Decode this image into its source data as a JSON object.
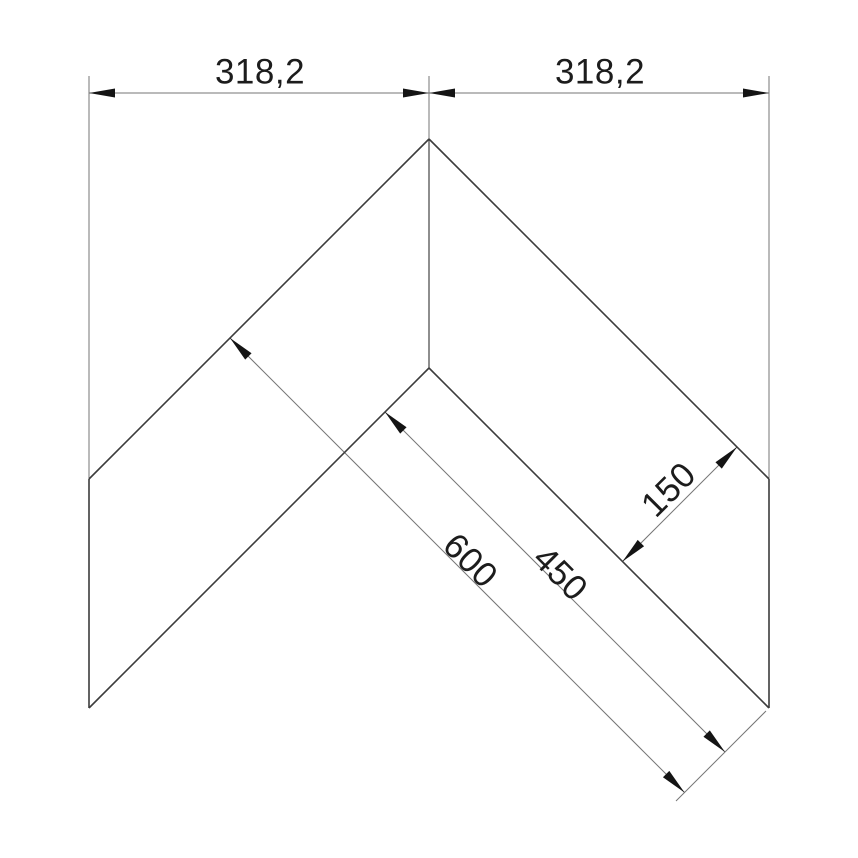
{
  "canvas": {
    "width": 858,
    "height": 858,
    "background": "#ffffff"
  },
  "palette": {
    "edge_color": "#3c3c3c",
    "crease_color": "#444444",
    "dim_line_color": "#757575",
    "arrow_fill": "#141414",
    "label_color": "#1c1c1c"
  },
  "drawing": {
    "type": "technical-dimension-drawing",
    "edges": [
      {
        "name": "outer-left-edge",
        "x1": 429,
        "y1": 139,
        "x2": 89,
        "y2": 479
      },
      {
        "name": "left-end-edge",
        "x1": 89,
        "y1": 479,
        "x2": 89,
        "y2": 708
      },
      {
        "name": "inner-left-edge",
        "x1": 89,
        "y1": 708,
        "x2": 429,
        "y2": 368
      },
      {
        "name": "outer-right-edge",
        "x1": 429,
        "y1": 139,
        "x2": 769,
        "y2": 479
      },
      {
        "name": "right-end-edge",
        "x1": 769,
        "y1": 479,
        "x2": 769,
        "y2": 708
      },
      {
        "name": "inner-right-edge",
        "x1": 429,
        "y1": 368,
        "x2": 769,
        "y2": 708
      }
    ],
    "crease_lines": [
      {
        "name": "corner-crease-line",
        "x1": 429,
        "y1": 139,
        "x2": 429,
        "y2": 368
      }
    ],
    "extension_lines": [
      {
        "name": "extension-line-left",
        "x1": 89,
        "y1": 76,
        "x2": 89,
        "y2": 479
      },
      {
        "name": "extension-line-center",
        "x1": 429,
        "y1": 76,
        "x2": 429,
        "y2": 139
      },
      {
        "name": "extension-line-right",
        "x1": 769,
        "y1": 76,
        "x2": 769,
        "y2": 479
      },
      {
        "name": "extension-line-end-plane",
        "x1": 766,
        "y1": 711,
        "x2": 676,
        "y2": 801
      }
    ],
    "dimension_lines": [
      {
        "name": "dim-line-318-left",
        "x1": 89,
        "y1": 93,
        "x2": 429,
        "y2": 93
      },
      {
        "name": "dim-line-318-right",
        "x1": 429,
        "y1": 93,
        "x2": 769,
        "y2": 93
      },
      {
        "name": "dim-line-600",
        "x1": 230,
        "y1": 338,
        "x2": 684.5,
        "y2": 792.5
      },
      {
        "name": "dim-line-450",
        "x1": 385,
        "y1": 412,
        "x2": 725,
        "y2": 752
      },
      {
        "name": "dim-line-150",
        "x1": 622.5,
        "y1": 561.5,
        "x2": 737,
        "y2": 447
      }
    ],
    "arrowheads": [
      {
        "name": "arrow-318-left-outer",
        "x": 89,
        "y": 93,
        "angle": 180
      },
      {
        "name": "arrow-318-left-inner",
        "x": 429,
        "y": 93,
        "angle": 0
      },
      {
        "name": "arrow-318-right-inner",
        "x": 429,
        "y": 93,
        "angle": 180
      },
      {
        "name": "arrow-318-right-outer",
        "x": 769,
        "y": 93,
        "angle": 0
      },
      {
        "name": "arrow-600-start",
        "x": 230,
        "y": 338,
        "angle": 225
      },
      {
        "name": "arrow-600-end",
        "x": 684.5,
        "y": 792.5,
        "angle": 45
      },
      {
        "name": "arrow-450-start",
        "x": 385,
        "y": 412,
        "angle": 225
      },
      {
        "name": "arrow-450-end",
        "x": 725,
        "y": 752,
        "angle": 45
      },
      {
        "name": "arrow-150-lower",
        "x": 622.5,
        "y": 561.5,
        "angle": 135
      },
      {
        "name": "arrow-150-upper",
        "x": 737,
        "y": 447,
        "angle": -45
      }
    ],
    "arrowhead_shape": "0,0 -26,-4.5 -26,4.5",
    "dimension_labels": [
      {
        "name": "dim-label-318-left",
        "text": "318,2",
        "x": 260,
        "y": 71,
        "rot": 0
      },
      {
        "name": "dim-label-318-right",
        "text": "318,2",
        "x": 600,
        "y": 71,
        "rot": 0
      },
      {
        "name": "dim-label-600",
        "text": "600",
        "x": 471,
        "y": 560,
        "rot": 45
      },
      {
        "name": "dim-label-450",
        "text": "450",
        "x": 561,
        "y": 573,
        "rot": 45
      },
      {
        "name": "dim-label-150",
        "text": "150",
        "x": 668,
        "y": 489,
        "rot": -45
      }
    ]
  }
}
